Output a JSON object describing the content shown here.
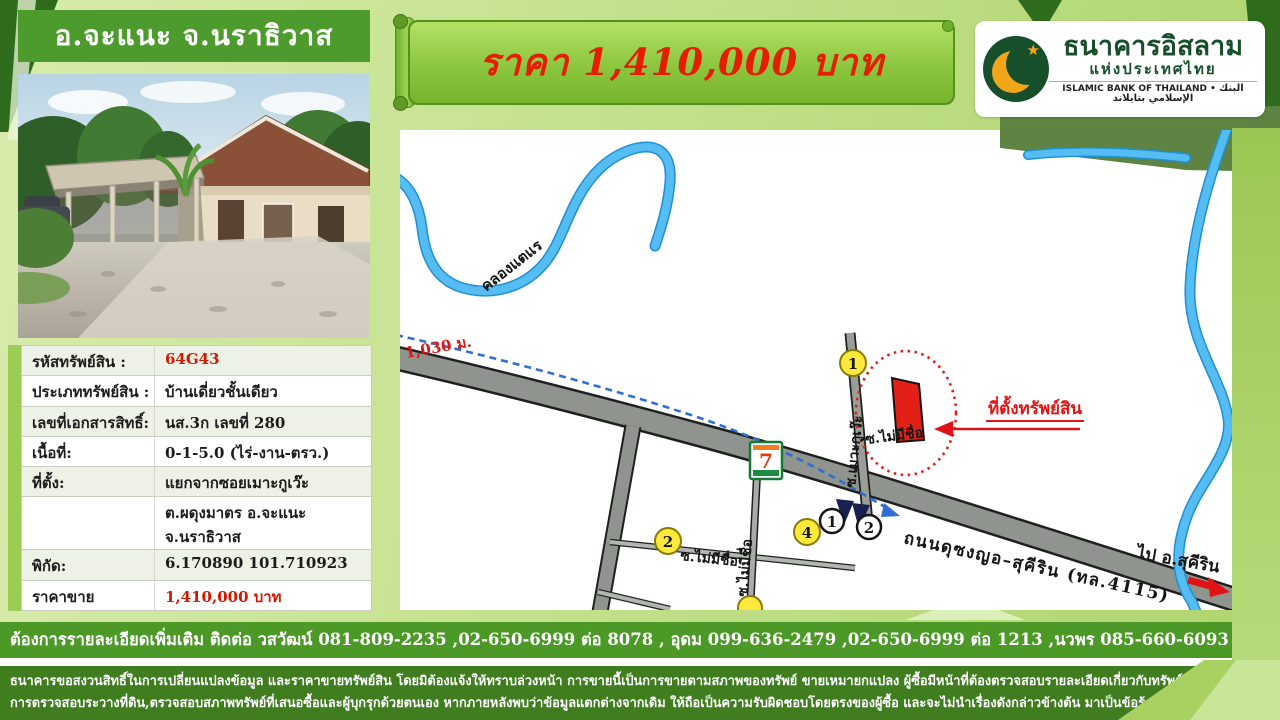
{
  "header": {
    "location": "อ.จะแนะ จ.นราธิวาส"
  },
  "banner": {
    "price_text": "ราคา 1,410,000 บาท"
  },
  "bank": {
    "name_th": "ธนาคารอิสลาม",
    "name_th2": "แห่งประเทศไทย",
    "name_en": "ISLAMIC BANK OF THAILAND",
    "separator": "•",
    "name_ar": "البنك الإسلامي بتايلاند"
  },
  "details": {
    "rows": [
      {
        "label": "รหัสทรัพย์สิน :",
        "value": "64G43"
      },
      {
        "label": "ประเภททรัพย์สิน :",
        "value": "บ้านเดี่ยวชั้นเดียว"
      },
      {
        "label": "เลขที่เอกสารสิทธิ์:",
        "value": "นส.3ก เลขที่ 280"
      },
      {
        "label": "เนื้อที่:",
        "value": "0-1-5.0  (ไร่-งาน-ตรว.)"
      },
      {
        "label": "ที่ตั้ง:",
        "value": "แยกจากซอยเมาะกูเว๊ะ"
      },
      {
        "label": "",
        "value": "ต.ผดุงมาตร อ.จะแนะ จ.นราธิวาส"
      },
      {
        "label": "พิกัด:",
        "value": "6.170890  101.710923"
      },
      {
        "label": "ราคาขาย",
        "value": "1,410,000 บาท"
      }
    ]
  },
  "map": {
    "canal_label": "คลองแตแร",
    "distance_label": "1,030 ม.",
    "main_road_label": "ถนนดุซงญอ–สุคีริน (ทล.4115)",
    "direction_label": "ไป อ.สุคีริน",
    "soi_mokuwe_label": "ซ.เมาะกูเว๊ะ",
    "soi_unnamed_label_1": "ซ.ไม่มีชื่อ",
    "soi_unnamed_label_2": "ซ.ไม่มีชื่อ",
    "soi_unnamed_label_3": "ซ.ไม่มีชื่อ",
    "property_callout": "ที่ตั้งทรัพย์สิน",
    "marker_yellow_1": "1",
    "marker_yellow_2": "2",
    "marker_yellow_4": "4",
    "marker_white_1": "1",
    "marker_white_2": "2",
    "seven_eleven_label": "7"
  },
  "contact": {
    "text": "ต้องการรายละเอียดเพิ่มเติม ติดต่อ วสวัฒน์ 081-809-2235 ,02-650-6999 ต่อ 8078  , อุดม 099-636-2479 ,02-650-6999 ต่อ 1213 ,นวพร 085-660-6093 , 02-650-69999 ต่อ 8075"
  },
  "disclaimer": {
    "line1": "ธนาคารขอสงวนสิทธิ์ในการเปลี่ยนแปลงข้อมูล และราคาขายทรัพย์สิน โดยมิต้องแจ้งให้ทราบล่วงหน้า การขายนี้เป็นการขายตามสภาพของทรัพย์ ขายเหมายกแปลง ผู้ซื้อมีหน้าที่ต้องตรวจสอบรายละเอียดเกี่ยวกับทรัพย์ฯ สถานที่ตั้งทรัพย์,แผนที่การเดินทาง,",
    "line2": "การตรวจสอบระวางที่ดิน,ตรวจสอบสภาพทรัพย์ที่เสนอซื้อและผู้บุกรุกด้วยตนเอง หากภายหลังพบว่าข้อมูลแตกต่างจากเดิม ให้ถือเป็นความรับผิดชอบโดยตรงของผู้ซื้อ และจะไม่นำเรื่องดังกล่าวข้างต้น มาเป็นข้อร้องเรียน/ข้อเรียกร้องใดๆต่อธนาคาร"
  },
  "colors": {
    "accent_green": "#4e9b2d",
    "dark_green": "#2e6b1d",
    "banner_green": "#8cc63f",
    "price_red": "#e61e00",
    "bank_green": "#174f2b",
    "gold": "#f2a71b",
    "river_blue": "#55bdf2",
    "parcel_red": "#e32017"
  }
}
